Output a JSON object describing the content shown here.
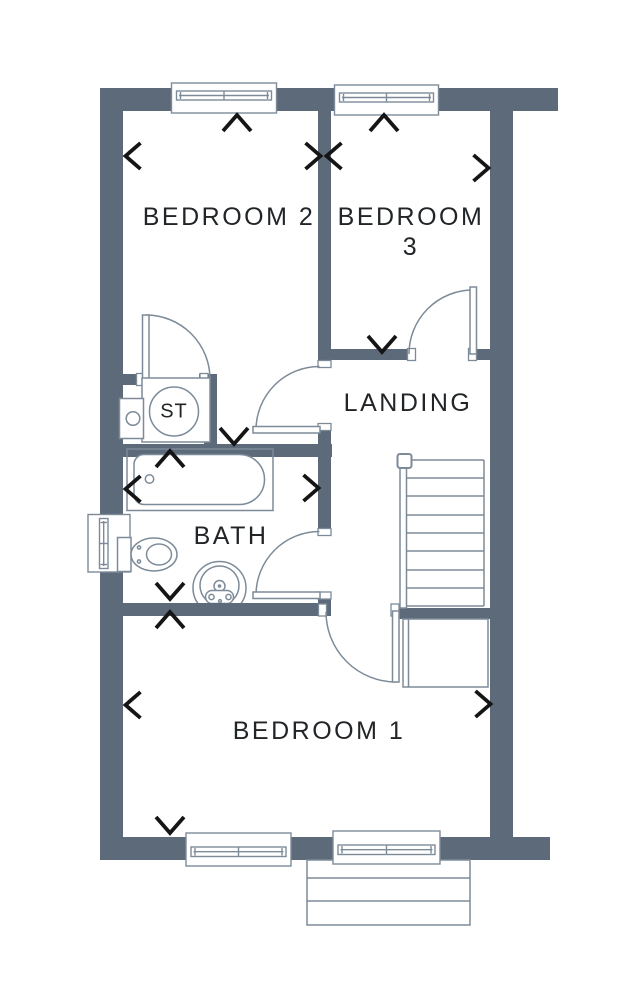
{
  "floorplan": {
    "rooms": {
      "bedroom2": {
        "label": "BEDROOM 2"
      },
      "bedroom3": {
        "label_line1": "BEDROOM",
        "label_line2": "3"
      },
      "landing": {
        "label": "LANDING"
      },
      "bath": {
        "label": "BATH"
      },
      "bedroom1": {
        "label": "BEDROOM 1"
      },
      "storage": {
        "label": "ST"
      }
    },
    "colors": {
      "wall": "#5c6a79",
      "line": "#7d8b99",
      "text": "#222527",
      "marker": "#151515",
      "background": "#ffffff"
    }
  }
}
